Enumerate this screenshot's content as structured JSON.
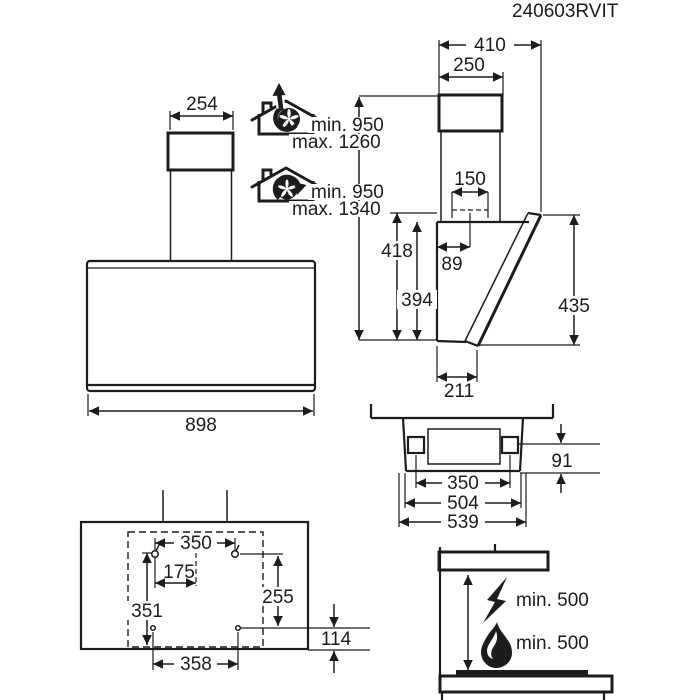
{
  "document": {
    "code": "240603RVIT"
  },
  "front_view": {
    "chimney_width": "254",
    "body_width": "898"
  },
  "side_view": {
    "depth_total": "410",
    "chimney_depth": "250",
    "duct_diameter": "150",
    "duct_offset": "89",
    "height_back_total": "418",
    "height_body": "394",
    "height_front": "435",
    "depth_bottom": "211"
  },
  "mounting_height": {
    "exhaust_min": "min. 950",
    "exhaust_max": "max. 1260",
    "recirc_min": "min. 950",
    "recirc_max": "max. 1340"
  },
  "bottom_view": {
    "bracket_spacing": "350",
    "width_mid": "504",
    "width_total": "539",
    "bracket_to_front": "91"
  },
  "drilling_template": {
    "top_holes_spacing": "350",
    "half_spacing": "175",
    "height_left": "351",
    "holes_vertical_spacing": "255",
    "lower_offset": "114",
    "lower_holes_spacing": "358"
  },
  "clearances": {
    "electric_hob": "min. 500",
    "gas_hob": "min. 500"
  }
}
